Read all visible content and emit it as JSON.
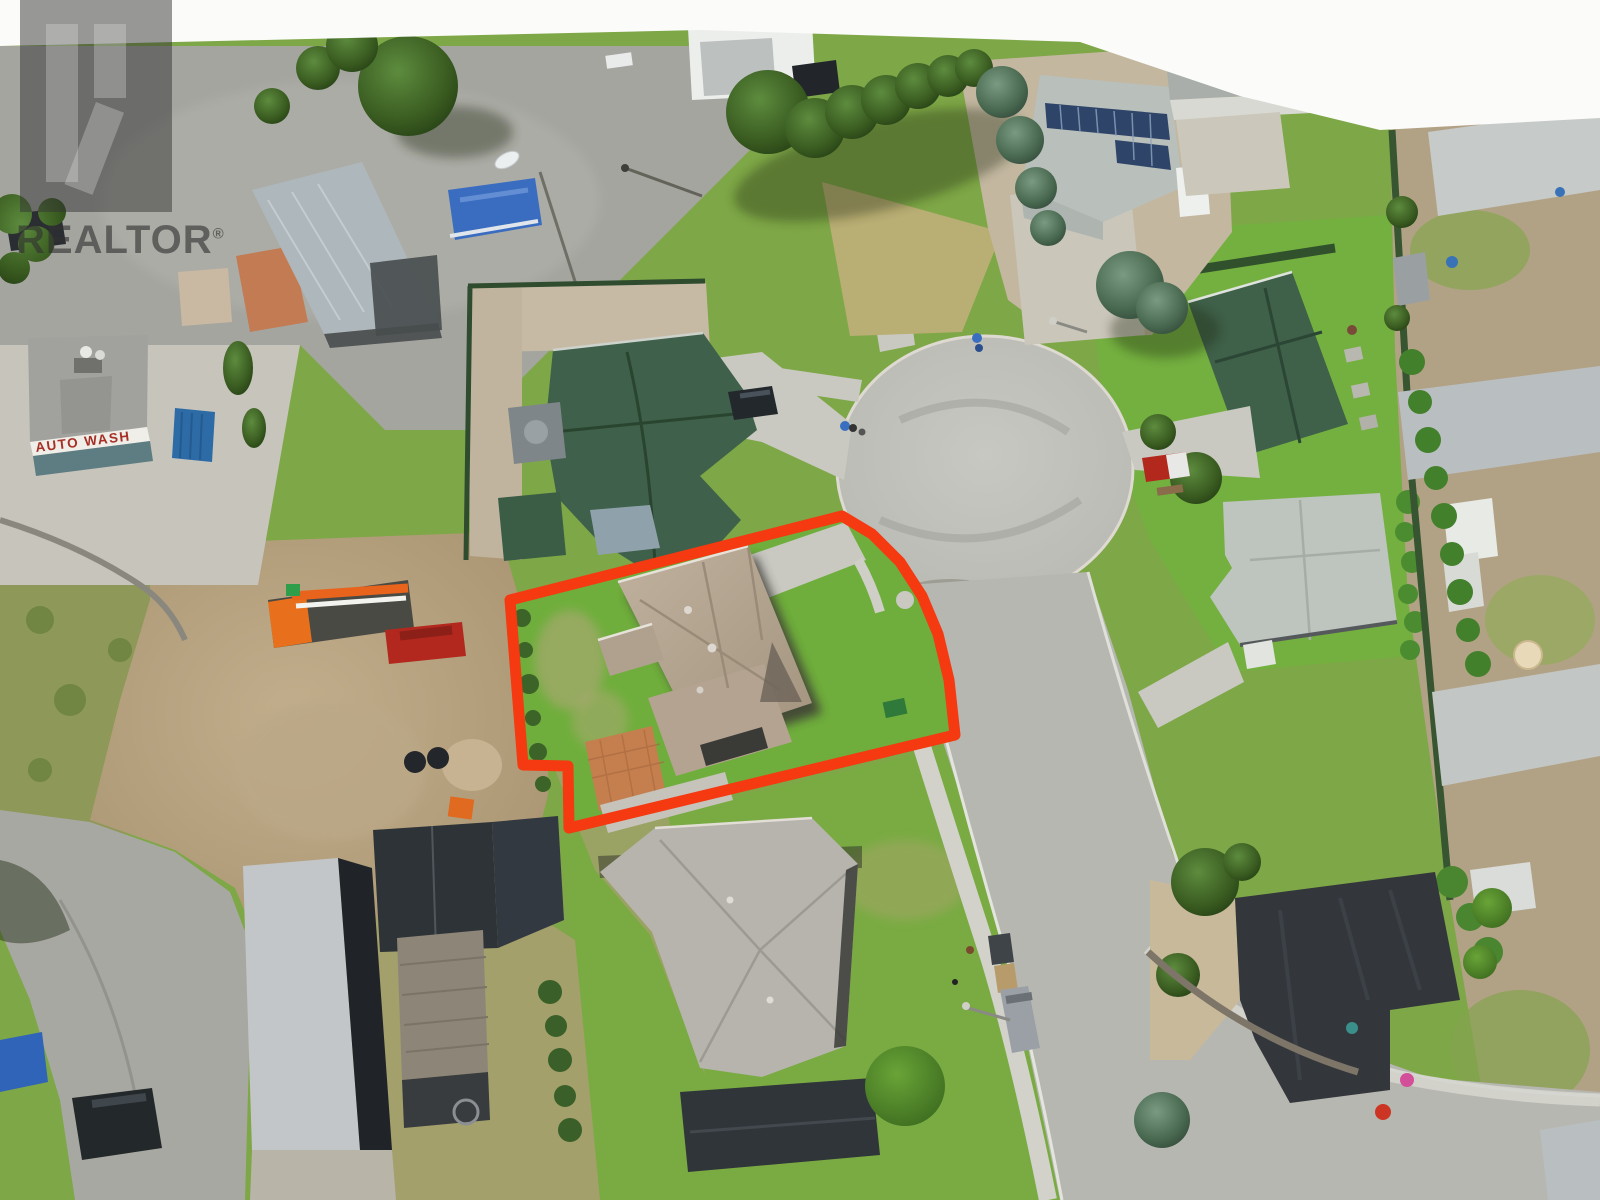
{
  "watermark": {
    "logo_icon": "realtor-r-logo",
    "brand": "REALTOR",
    "registered": "®"
  },
  "signs": {
    "auto_wash": "AUTO WASH"
  },
  "colors": {
    "outline_red": "#f53910",
    "grass_green": "#7ea747",
    "bright_lawn": "#74b040",
    "dry_grass": "#a8a46b",
    "dirt": "#b4a07e",
    "asphalt": "#a5a5a0",
    "concrete": "#c9c9c2",
    "cul_de_sac": "#c0c0ba",
    "subject_roof_tan": "#b5a492",
    "green_roof": "#3f604a",
    "dark_roof": "#30353a",
    "light_roof": "#bec4be",
    "solar_panel_blue": "#2e4468",
    "terracotta_patio": "#c57f4f",
    "tarp_blue": "#3a6cc0"
  },
  "property_outline": {
    "color": "#f53910",
    "stroke_width": 11,
    "points": "510,600 842,516 872,534 900,562 922,596 938,634 949,680 955,735 569,828 568,766 523,765"
  }
}
